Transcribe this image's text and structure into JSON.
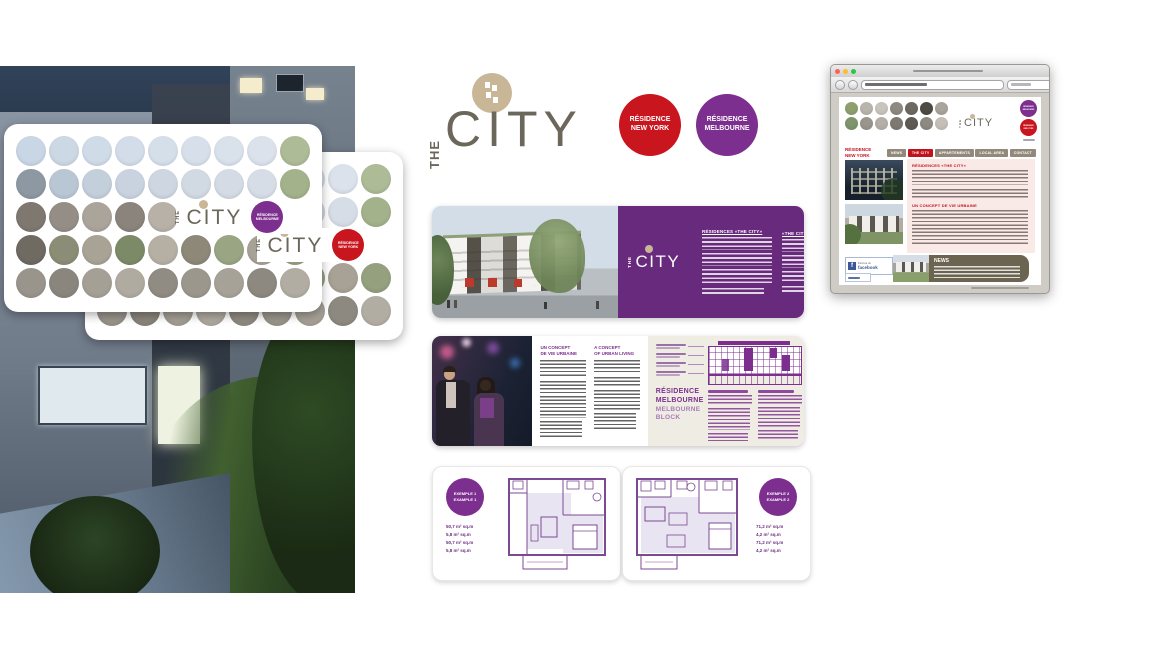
{
  "brand": {
    "the": "THE",
    "city": "CITY",
    "badges": {
      "new_york": [
        "RÉSIDENCE",
        "NEW YORK"
      ],
      "melbourne": [
        "RÉSIDENCE",
        "MELBOURNE"
      ]
    }
  },
  "colors": {
    "purple": "#7c2f8f",
    "purple_panel": "#682a7c",
    "red": "#c9151e",
    "gold": "#c9b696",
    "taupe": "#6c675b",
    "olive": "#6b6450",
    "pink": "#f9e9e7",
    "cream": "#efece4",
    "facebook_blue": "#3b5998"
  },
  "palettes": {
    "card_grid": [
      [
        "#c9d6e6",
        "#ccd8e4",
        "#d0dbe8",
        "#d3dde9",
        "#d5dfea",
        "#d7e0ea",
        "#d9e1eb",
        "#dbe2ec",
        "#aebb97"
      ],
      [
        "#8d98a2",
        "#b9c6d4",
        "#c4cfdc",
        "#c9d3df",
        "#cdd6e1",
        "#d1d9e3",
        "#d4dbe5",
        "#d7dde7",
        "#a3b28b"
      ],
      [
        "#7e7871",
        "#948e86",
        "#aaa49b",
        "#8a847c",
        "#b7b1a8",
        "#9d978e",
        "#c7c1b8",
        "#b1aba2",
        "#8f9a7a"
      ],
      [
        "#6f6a62",
        "#8c8d76",
        "#a9a396",
        "#7d8a68",
        "#b5afa4",
        "#8e8878",
        "#9aa584",
        "#a8a296",
        "#95a07e"
      ],
      [
        "#9a958c",
        "#8b867d",
        "#a5a096",
        "#b0aba1",
        "#918c83",
        "#9c978d",
        "#a7a298",
        "#8d8980",
        "#b2ada3"
      ]
    ],
    "web_grid": [
      [
        "#8fa06f",
        "#b9b5ad",
        "#c9c5bd",
        "#8e8a82",
        "#6e6a62",
        "#4e4a44",
        "#a9a59d"
      ],
      [
        "#7f956b",
        "#9a968e",
        "#b4b0a8",
        "#7e7a72",
        "#5e5a54",
        "#8e8a82",
        "#c4c0b8"
      ]
    ]
  },
  "brochure_city": {
    "col1_heading": "RÉSIDENCES «THE CITY»",
    "col2_heading": "«THE CITY» RESIDENCES"
  },
  "brochure_concept": {
    "col1_heading": [
      "UN CONCEPT",
      "DE VIE URBAINE"
    ],
    "col2_heading": [
      "A CONCEPT",
      "OF URBAN LIVING"
    ]
  },
  "melbourne_panel": {
    "title": [
      "RÉSIDENCE",
      "MELBOURNE"
    ],
    "subtitle": [
      "MELBOURNE",
      "BLOCK"
    ]
  },
  "floorplans": [
    {
      "badge": [
        "EXEMPLE 1",
        "EXAMPLE 1"
      ],
      "specs": [
        {
          "v": "50,7 m²  sq.m"
        },
        {
          "v": "5,8 m²  sq.m"
        },
        {
          "v": "50,7 m²  sq.m"
        },
        {
          "v": "5,8 m²  sq.m"
        }
      ]
    },
    {
      "badge": [
        "EXEMPLE 2",
        "EXAMPLE 2"
      ],
      "specs": [
        {
          "v": "71,2 m²  sq.m"
        },
        {
          "v": "4,2 m²  sq.m"
        },
        {
          "v": "71,2 m²  sq.m"
        },
        {
          "v": "4,2 m²  sq.m"
        }
      ]
    }
  ],
  "website": {
    "sidebar_title": [
      "RÉSIDENCE",
      "NEW YORK"
    ],
    "nav": [
      {
        "label": "NEWS",
        "active": false
      },
      {
        "label": "THE CITY",
        "active": true
      },
      {
        "label": "APPARTEMENTS",
        "active": false
      },
      {
        "label": "LOCAL AREA",
        "active": false
      },
      {
        "label": "CONTACT",
        "active": false
      }
    ],
    "heading1": "RÉSIDENCES «THE CITY»",
    "heading2": "UN CONCEPT DE VIE URBAINE",
    "news_title": "NEWS",
    "facebook_badge": [
      "Find us on",
      "facebook"
    ]
  }
}
